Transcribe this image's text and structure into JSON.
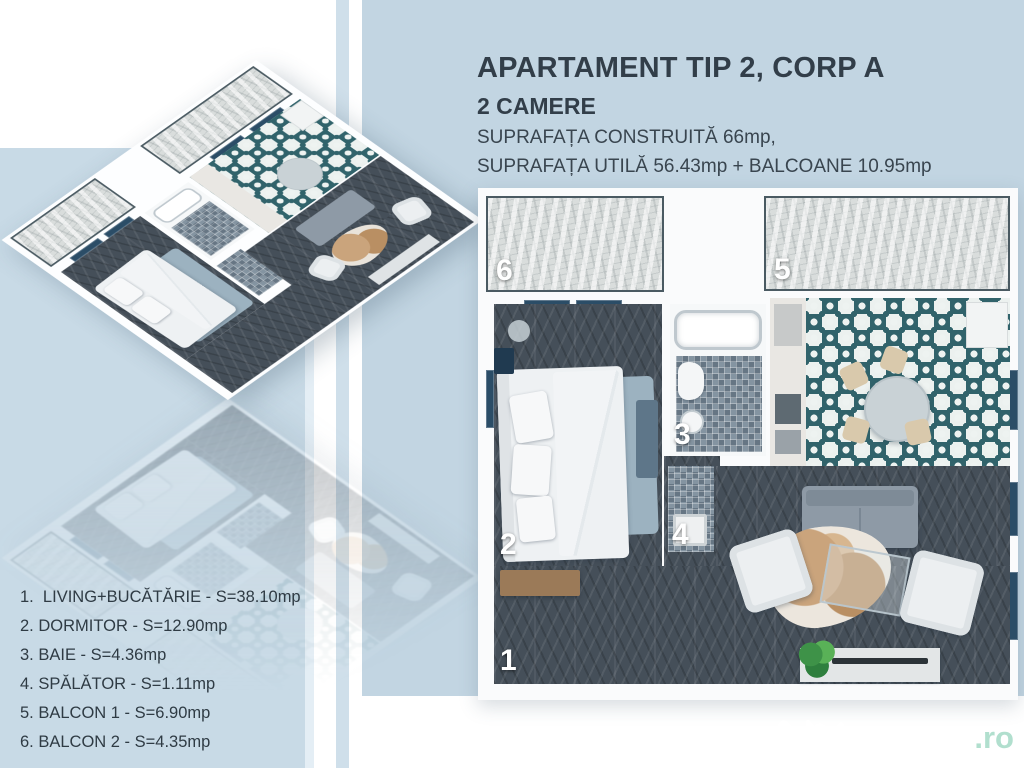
{
  "header": {
    "title": "APARTAMENT TIP 2, CORP A",
    "subtitle": "2 CAMERE",
    "area_line1": "SUPRAFAȚA CONSTRUITĂ 66mp,",
    "area_line2": "SUPRAFAȚA UTILĂ 56.43mp + BALCOANE 10.95mp"
  },
  "legend": {
    "items": [
      "1.  LIVING+BUCĂTĂRIE - S=38.10mp",
      "2. DORMITOR - S=12.90mp",
      "3. BAIE - S=4.36mp",
      "4. SPĂLĂTOR - S=1.11mp",
      "5. BALCON 1 - S=6.90mp",
      "6. BALCON 2 - S=4.35mp"
    ]
  },
  "plan": {
    "numbers": {
      "living": "1",
      "bedroom": "2",
      "bath": "3",
      "laundry": "4",
      "balcony1": "5",
      "balcony2": "6"
    }
  },
  "watermark": {
    "brand": "lajumate",
    "tld": ".ro"
  },
  "colors": {
    "panel_left": "#c8dae6",
    "panel_right": "#c2d5e2",
    "stripe": "#cfdfea",
    "tile_teal": "#31636b",
    "floor_dark": "#454f59",
    "window_frame": "#2b4d67",
    "text_dark": "#323e49",
    "watermark_tld": "#a9dcc9"
  }
}
